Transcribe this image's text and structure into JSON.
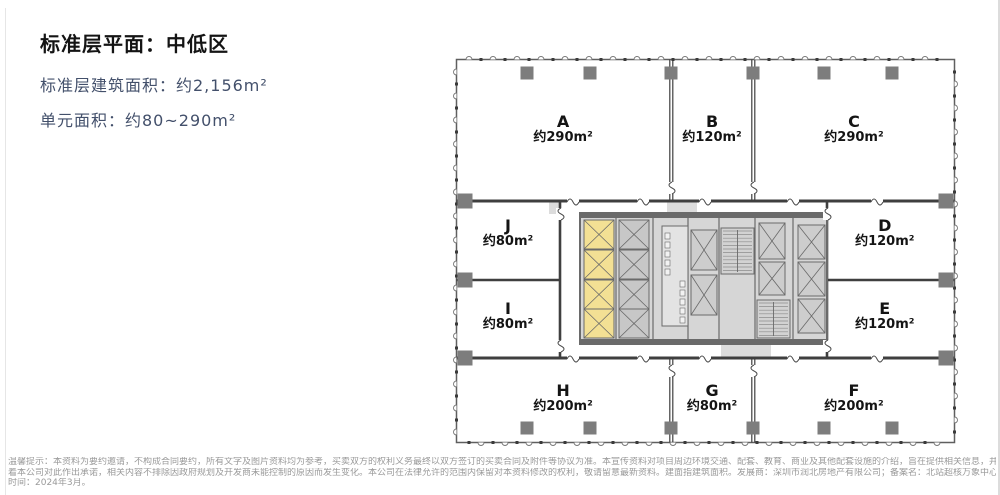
{
  "header": {
    "title": "标准层平面：中低区",
    "line_area": "标准层建筑面积：约2,156m²",
    "line_unit": "单元面积：约80~290m²"
  },
  "floorplan": {
    "units": [
      {
        "label": "A",
        "area": "约290m²"
      },
      {
        "label": "B",
        "area": "约120m²"
      },
      {
        "label": "C",
        "area": "约290m²"
      },
      {
        "label": "J",
        "area": "约80m²"
      },
      {
        "label": "D",
        "area": "约120m²"
      },
      {
        "label": "I",
        "area": "约80m²"
      },
      {
        "label": "E",
        "area": "约120m²"
      },
      {
        "label": "H",
        "area": "约200m²"
      },
      {
        "label": "G",
        "area": "约80m²"
      },
      {
        "label": "F",
        "area": "约200m²"
      }
    ],
    "colors": {
      "highlight_unit": "#F3E094",
      "core_background": "#D6D6D6",
      "core_wall": "#6A6A6A",
      "partition_wall": "#3F3F3F",
      "column": "#7D7D7D",
      "boundary": "#5F5F5F"
    }
  },
  "disclaimer": {
    "lines": [
      "温馨提示：本资料为要约邀请，不构成合同要约，所有文字及图片资料均为参考，买卖双方的权利义务最终以双方签订的买卖合同及附件等协议为准。本宣传资料对项目周边环境交通、配套、教育、商业及其他配套设施的介绍，旨在提供相关信息，并不意味",
      "着本公司对此作出承诺，相关内容不排除因政府规划及开发商未能控制的原因而发生变化。本公司在法律允许的范围内保留对本资料修改的权利，敬请留意最新资料。建面指建筑面积。发展商：深圳市润北房地产有限公司；备案名：北站超核万象中心。制作",
      "时间：2024年3月。"
    ]
  }
}
